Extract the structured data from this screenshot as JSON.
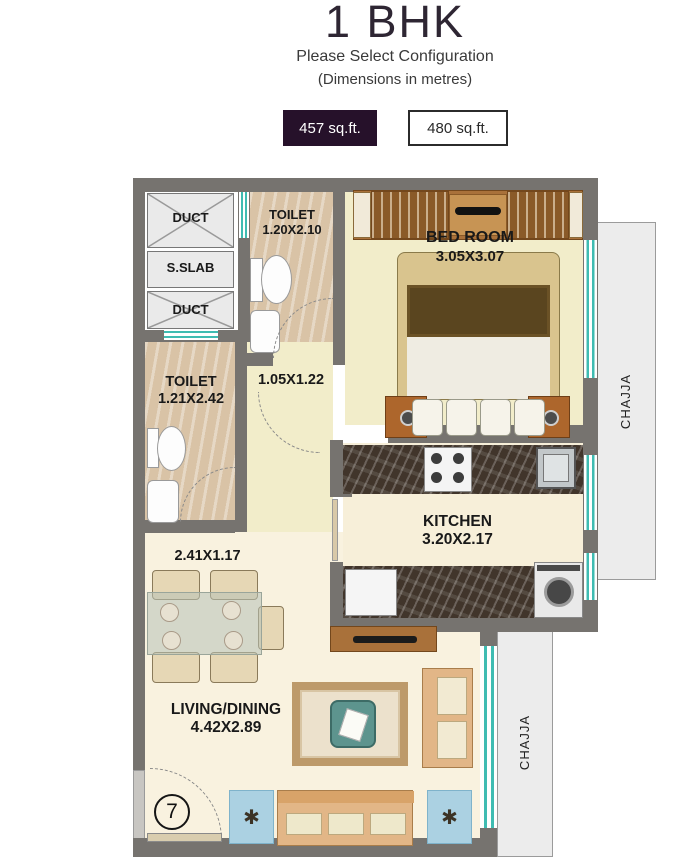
{
  "header": {
    "title": "1 BHK",
    "subtitle": "Please Select Configuration",
    "note": "(Dimensions in metres)"
  },
  "config": {
    "options": [
      {
        "label": "457 sq.ft.",
        "selected": true
      },
      {
        "label": "480 sq.ft.",
        "selected": false
      }
    ]
  },
  "colors": {
    "accent": "#26112a",
    "window_teal": "#3fbcb2",
    "wall_gray": "#76736f",
    "chajja_bg": "#ececec"
  },
  "plan": {
    "ducts": {
      "duct_top": "DUCT",
      "sslab": "S.SLAB",
      "duct_bottom": "DUCT"
    },
    "toilet_top": {
      "name": "TOILET",
      "dim": "1.20X2.10"
    },
    "bedroom": {
      "name": "BED ROOM",
      "dim": "3.05X3.07"
    },
    "toilet_left": {
      "name": "TOILET",
      "dim": "1.21X2.42"
    },
    "passage": {
      "dim": "1.05X1.22"
    },
    "kitchen": {
      "name": "KITCHEN",
      "dim": "3.20X2.17"
    },
    "lobby": {
      "dim": "2.41X1.17"
    },
    "living": {
      "name": "LIVING/DINING",
      "dim": "4.42X2.89"
    },
    "chajja_right": {
      "label": "CHAJJA"
    },
    "chajja_bottom": {
      "label": "CHAJJA"
    },
    "unit_number": "7"
  }
}
